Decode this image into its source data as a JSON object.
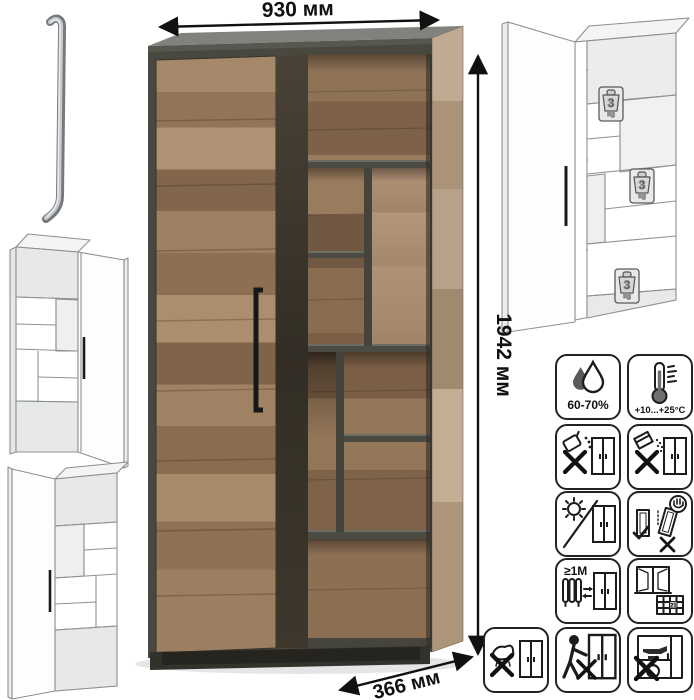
{
  "product": {
    "kind": "wardrobe-with-open-shelving"
  },
  "dimensions": {
    "width_label": "930 мм",
    "height_label": "1942 мм",
    "depth_label": "366 мм"
  },
  "weight_badge": {
    "value": "3",
    "unit": "kg"
  },
  "colors": {
    "wood": "#9c7e60",
    "frame": "#49483f"
  },
  "care_grid": {
    "items": [
      {
        "name": "humidity-icon",
        "label": "60-70%"
      },
      {
        "name": "temperature-icon",
        "label": "+10...+25°C"
      },
      {
        "name": "no-liquids-icon",
        "label": ""
      },
      {
        "name": "no-powder-icon",
        "label": ""
      },
      {
        "name": "no-direct-sunlight-icon",
        "label": ""
      },
      {
        "name": "carry-upright-icon",
        "label": ""
      },
      {
        "name": "radiator-distance-icon",
        "label": "≥1M"
      },
      {
        "name": "ventilation-calendar-icon",
        "label": "21"
      },
      {
        "name": "no-wet-cleaning-icon",
        "label": ""
      },
      {
        "name": "no-pushing-icon",
        "label": ""
      },
      {
        "name": "no-heavy-load-icon",
        "label": ""
      }
    ]
  }
}
